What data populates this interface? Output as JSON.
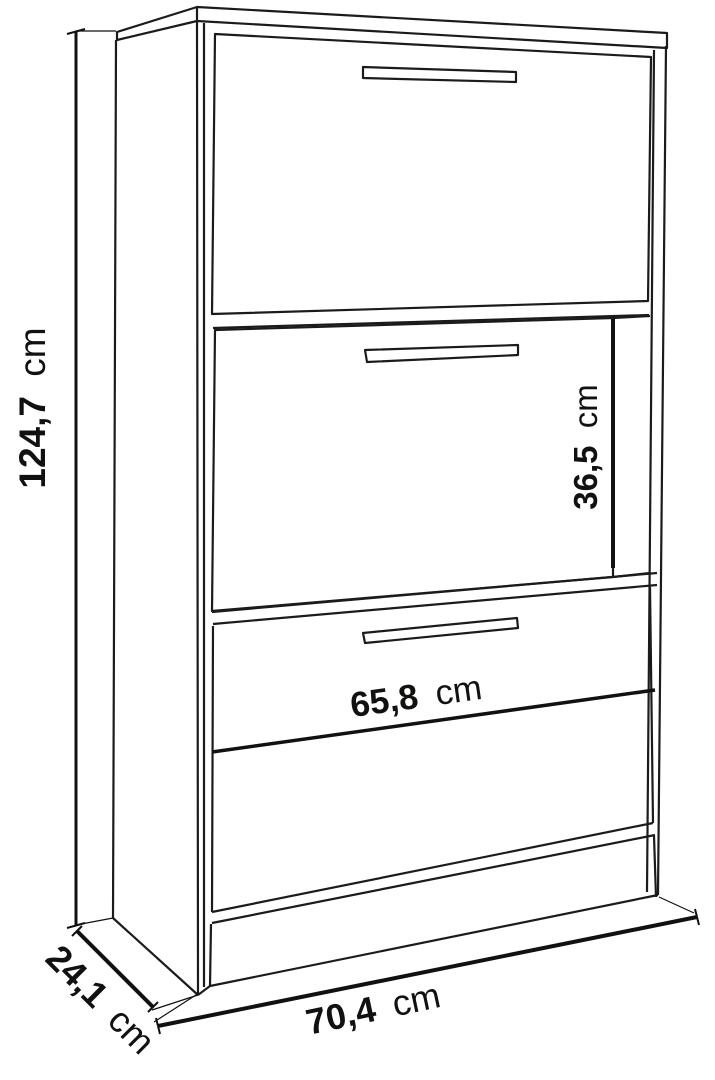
{
  "diagram": {
    "background": "#ffffff",
    "line_color": "#1b1b19",
    "dimension_line_color": "#111110",
    "labels": {
      "height": {
        "value": "124,7",
        "unit": "cm"
      },
      "depth": {
        "value": "24,1",
        "unit": "cm"
      },
      "width": {
        "value": "70,4",
        "unit": "cm"
      },
      "inner_width": {
        "value": "65,8",
        "unit": "cm"
      },
      "inner_height": {
        "value": "36,5",
        "unit": "cm"
      }
    }
  }
}
